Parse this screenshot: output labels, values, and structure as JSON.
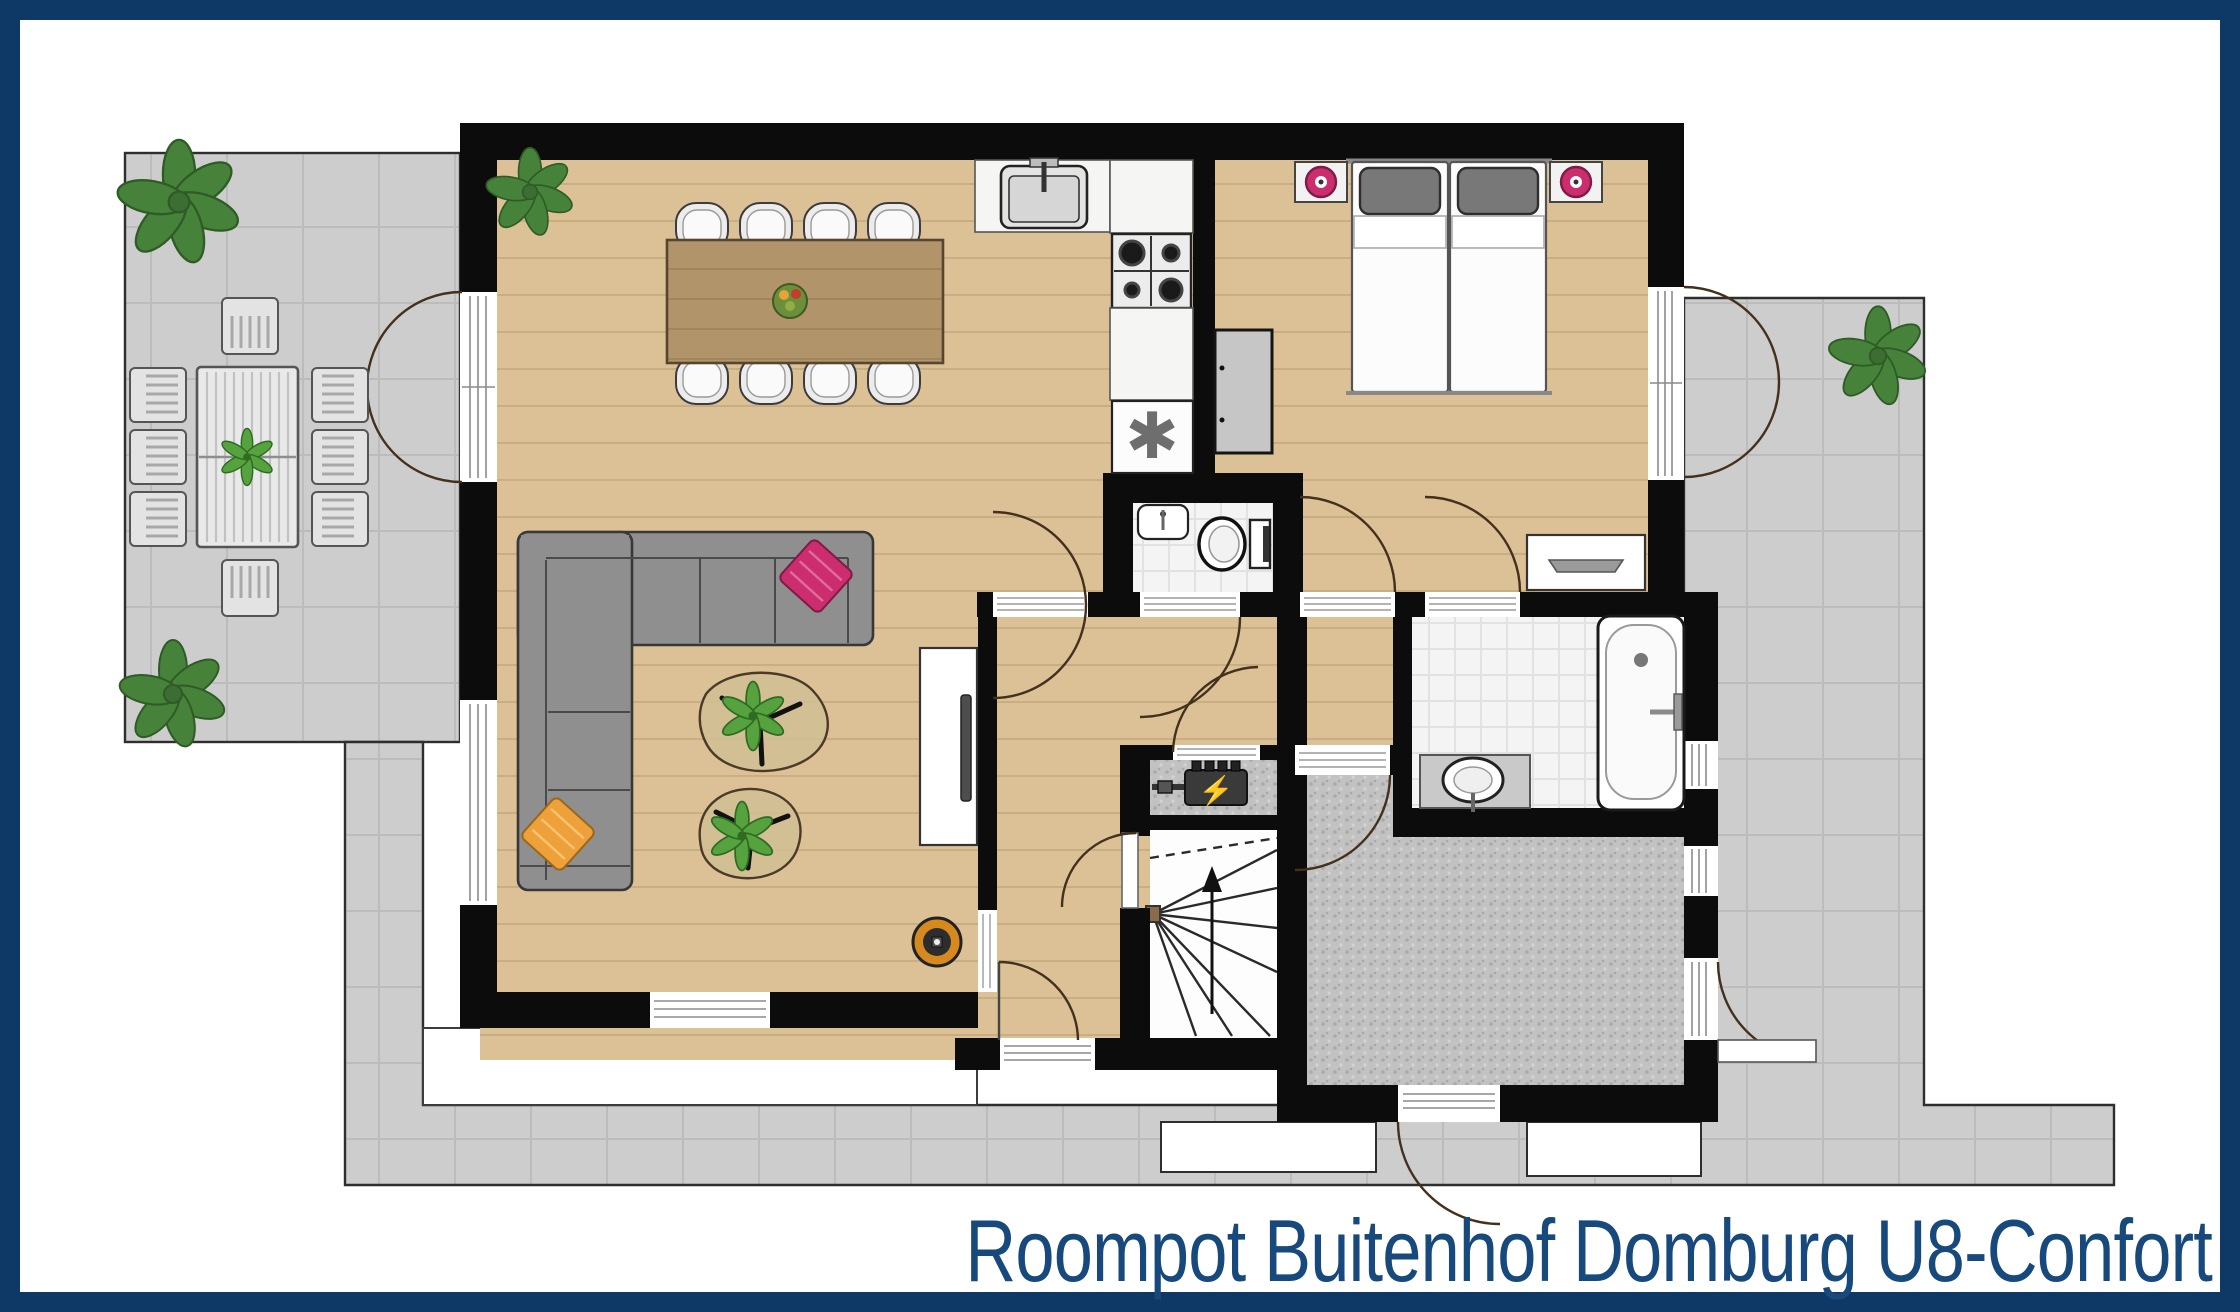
{
  "title": {
    "text": "Roompot Buitenhof Domburg U8-Confort"
  },
  "glyphs": {
    "freezer_symbol": "✱",
    "power_symbol": "⚡"
  },
  "colors": {
    "navy": "#0e3966",
    "titleColor": "#17497c",
    "wall": "#0c0c0c",
    "wood": "#dcc196",
    "woodLine": "#b99e73",
    "tableWood": "#b2946b",
    "tableLine": "#9c7f56",
    "terrace": "#cdcdcd",
    "terraceLine": "#bcbcbc",
    "outline": "#2e2e2e",
    "tile": "#f4f4f4",
    "tileLine": "#e2e2e2",
    "speckleA": "#c2c2c2",
    "speckleB": "#a9a9a9",
    "stairsFloor": "#fdfdfd",
    "fixture": "#ffffff",
    "fixtureStroke": "#1c1c1c",
    "counter": "#f5f5f3",
    "steel": "#d6d6d6",
    "sofa": "#8f8f8f",
    "sofaLine": "#4a4a4a",
    "cushionPink": "#cb2d6f",
    "cushionOrange": "#eea13b",
    "plant": "#47823a",
    "plantDark": "#2e5b26",
    "chair": "#ececec",
    "bedPillow": "#787878",
    "wardrobe": "#c6c6c6",
    "lampRing": "#d5891e",
    "bolt": "#f2c51d",
    "arcColor": "#43301d"
  }
}
